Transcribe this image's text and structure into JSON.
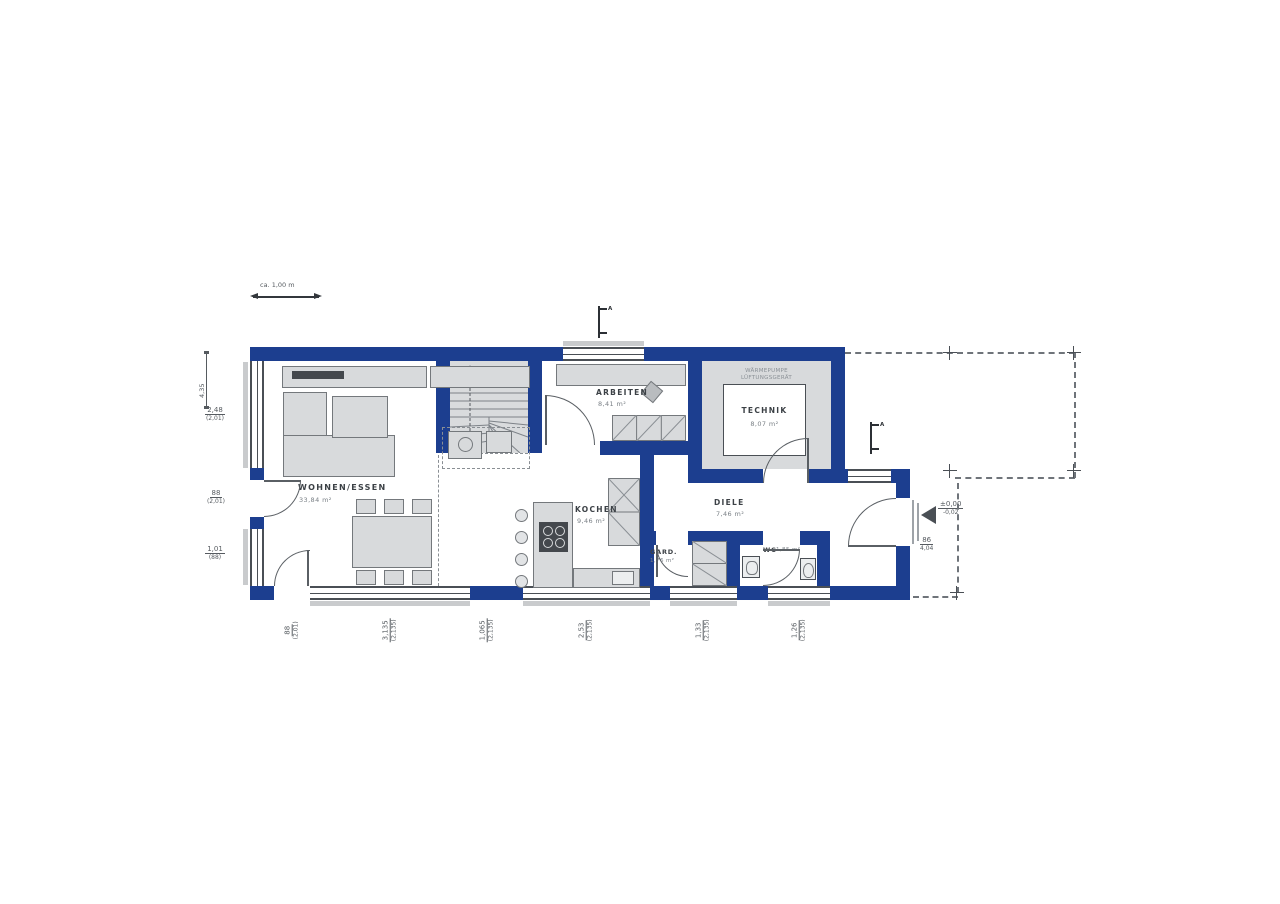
{
  "scale_bar": {
    "label": "ca. 1,00 m"
  },
  "rooms": {
    "wohnen_essen": {
      "name": "WOHNEN/ESSEN",
      "area": "33,84 m²"
    },
    "arbeiten": {
      "name": "ARBEITEN",
      "area": "8,41 m²"
    },
    "technik": {
      "name": "TECHNIK",
      "area": "8,07 m²",
      "note1": "WÄRMEPUMPE",
      "note2": "LÜFTUNGSGERÄT"
    },
    "kochen": {
      "name": "KOCHEN",
      "area": "9,46 m²"
    },
    "diele": {
      "name": "DIELE",
      "area": "7,46 m²"
    },
    "garderobe": {
      "name": "GARD.",
      "area": "1,76 m²"
    },
    "wc": {
      "name": "WC",
      "area": "1,85 m²"
    }
  },
  "dimensions": {
    "left_rotated": "4,35",
    "left": [
      {
        "v": "2,48",
        "s": "(2,01)"
      },
      {
        "v": "88",
        "s": "(2,01)"
      },
      {
        "v": "1,01",
        "s": "(88)"
      }
    ],
    "bottom": [
      {
        "v": "88",
        "s": "(2,01)"
      },
      {
        "v": "3,135",
        "s": "(2,135)"
      },
      {
        "v": "1,065",
        "s": "(2,135)"
      },
      {
        "v": "2,53",
        "s": "(2,135)"
      },
      {
        "v": "1,33",
        "s": "(2,135)"
      },
      {
        "v": "1,26",
        "s": "(2,135)"
      }
    ],
    "right": {
      "v": "86",
      "s": "4,04"
    }
  },
  "entrance": {
    "level_upper": "±0,00",
    "level_lower": "-0,02"
  },
  "section_marker": {
    "label": "A"
  },
  "colors": {
    "wall_blue": "#1c3e8f",
    "furniture_gray": "#d8dadc",
    "dimension_gray": "#565b60"
  }
}
